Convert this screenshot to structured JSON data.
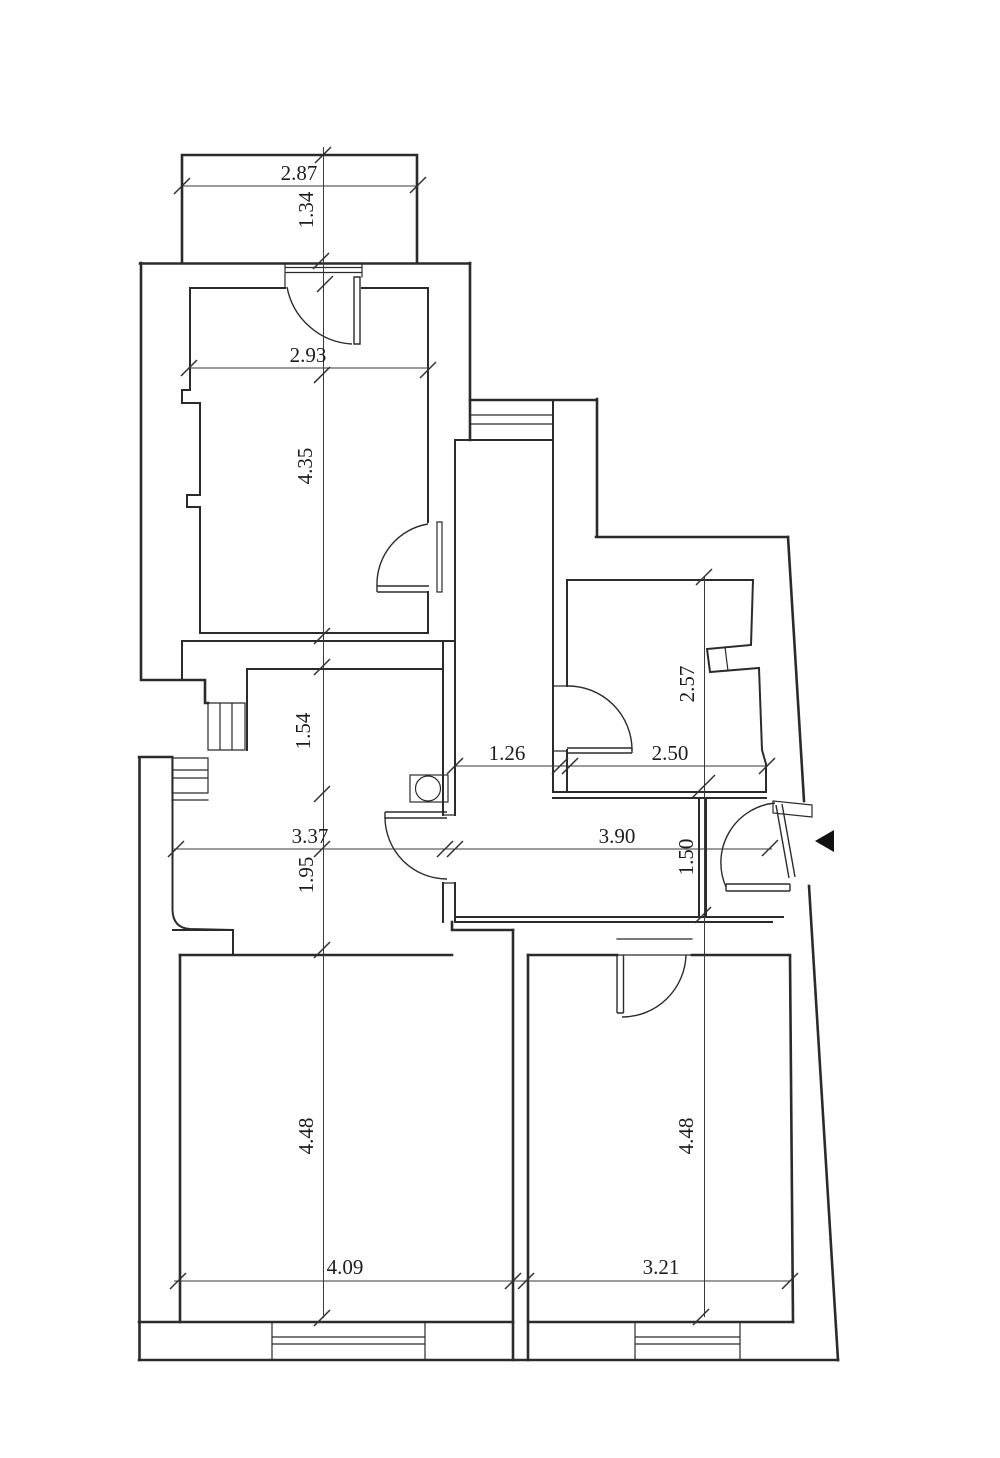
{
  "drawing": {
    "type": "architectural floor plan",
    "ink_color": "#2b2b2b",
    "background_color": "#ffffff",
    "dimensions": {
      "balcony_width": "2.87",
      "balcony_depth": "1.34",
      "room_top_width": "2.93",
      "room_top_height": "4.35",
      "corridor_upper_height": "1.54",
      "corridor_width": "3.37",
      "corridor_lower_height": "1.95",
      "hall_width": "1.26",
      "bath_width": "2.50",
      "bath_height": "2.57",
      "hallway_width": "3.90",
      "hallway_height": "1.50",
      "room_left_height": "4.48",
      "room_left_width": "4.09",
      "room_right_height": "4.48",
      "room_right_width": "3.21"
    }
  }
}
